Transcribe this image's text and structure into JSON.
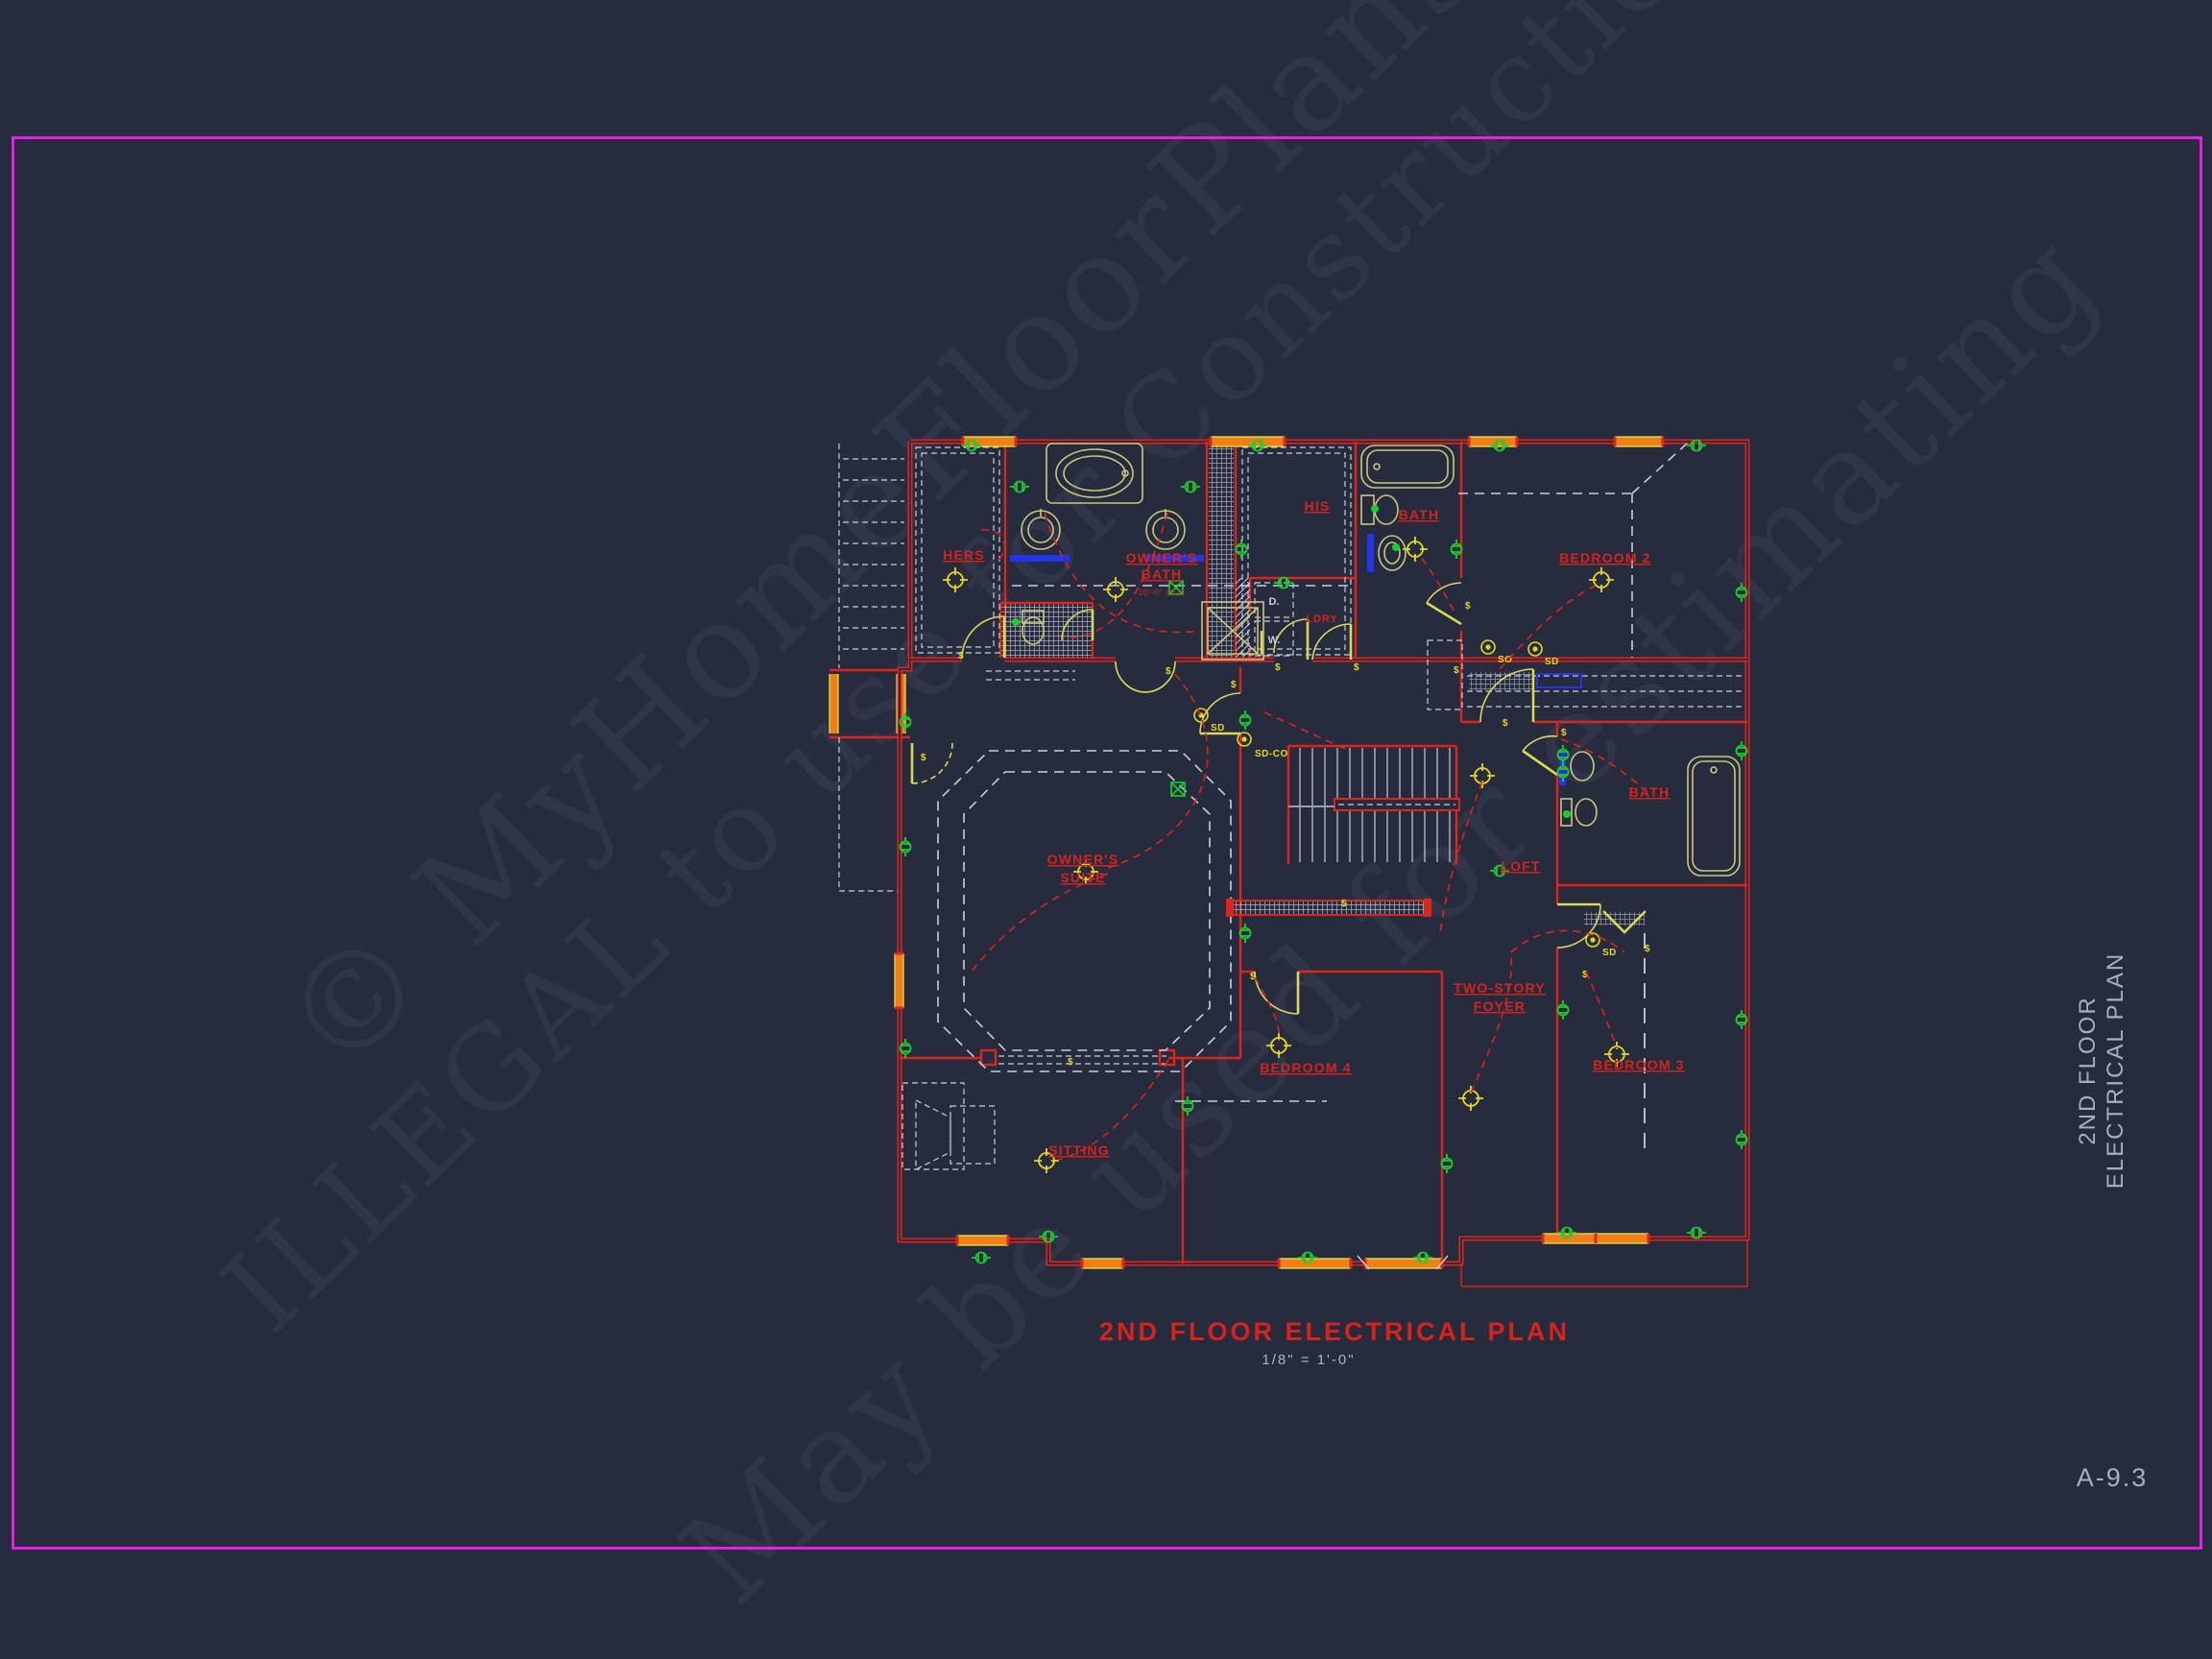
{
  "colors": {
    "background": "#262b3e",
    "border_magenta": "#e51fe5",
    "wall_red": "#e0241a",
    "label_red": "#d8231c",
    "door_yellow": "#d9d957",
    "fixture_khaki": "#c8c87c",
    "window_orange": "#ef7f16",
    "outlet_green": "#1bce2e",
    "symbol_yellow": "#e7d81f",
    "dash_white": "#c9cedd",
    "counter_blue": "#2335e8",
    "text_gray": "#a9afbc"
  },
  "watermark": {
    "line1": "© MyHomeFloorPlans.com",
    "line2": "ILLEGAL to use for Construction",
    "line3": "May be used for estimating"
  },
  "plan": {
    "rooms": {
      "hers": "HERS",
      "owners_bath_1": "OWNER'S",
      "owners_bath_2": "BATH",
      "owners_bath_clg": "10'-0\" CLG",
      "his": "HIS",
      "bath_top": "BATH",
      "bedroom2": "BEDROOM 2",
      "dryer": "D.",
      "laundry": "LDRY",
      "washer": "W.",
      "owners_suite_1": "OWNER'S",
      "owners_suite_2": "SUITE",
      "loft": "LOFT",
      "bath_right": "BATH",
      "foyer_1": "TWO-STORY",
      "foyer_2": "FOYER",
      "bedroom4": "BEDROOM 4",
      "bedroom3": "BEDROOM 3",
      "sitting": "SITTING"
    },
    "symbols": {
      "sd": "SD",
      "sd_co": "SD-CO",
      "so": "SO",
      "switch": "$"
    }
  },
  "title_block": {
    "title": "2ND FLOOR ELECTRICAL PLAN",
    "scale": "1/8\" = 1'-0\"",
    "side_line1": "2ND FLOOR",
    "side_line2": "ELECTRICAL PLAN",
    "sheet_number": "A-9.3"
  }
}
